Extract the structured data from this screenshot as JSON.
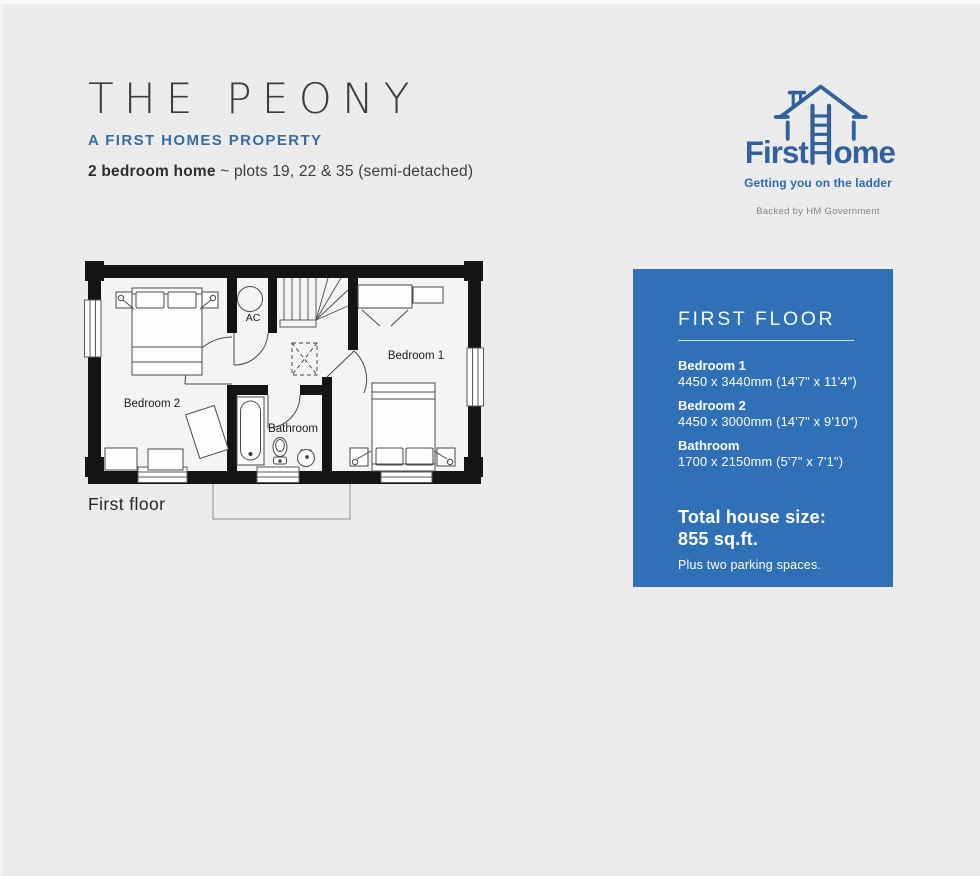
{
  "page": {
    "background_color": "#ebeceb"
  },
  "header": {
    "title": "THE PEONY",
    "subtitle": "A FIRST HOMES PROPERTY",
    "plots_bold": "2 bedroom home",
    "plots_rest": "~ plots 19, 22 & 35 (semi-detached)"
  },
  "logo": {
    "brand_first": "First",
    "brand_homes_rest": "omes",
    "tagline": "Getting you on the ladder",
    "backed_by": "Backed by HM Government",
    "brand_color": "#31619f"
  },
  "floorplan": {
    "floor_label": "First floor",
    "room_labels": {
      "bedroom1": "Bedroom 1",
      "bedroom2": "Bedroom 2",
      "bathroom": "Bathroom",
      "ac": "AC"
    }
  },
  "info_panel": {
    "background_color": "#2f70b7",
    "heading": "FIRST FLOOR",
    "rooms": [
      {
        "name": "Bedroom 1",
        "dimensions": "4450 x 3440mm (14'7\" x 11'4\")"
      },
      {
        "name": "Bedroom 2",
        "dimensions": "4450 x 3000mm (14'7\" x 9'10\")"
      },
      {
        "name": "Bathroom",
        "dimensions": "1700 x 2150mm (5'7\" x 7'1\")"
      }
    ],
    "total_size_label": "Total house size:",
    "total_size_value": "855 sq.ft.",
    "parking_note": "Plus two parking spaces."
  }
}
